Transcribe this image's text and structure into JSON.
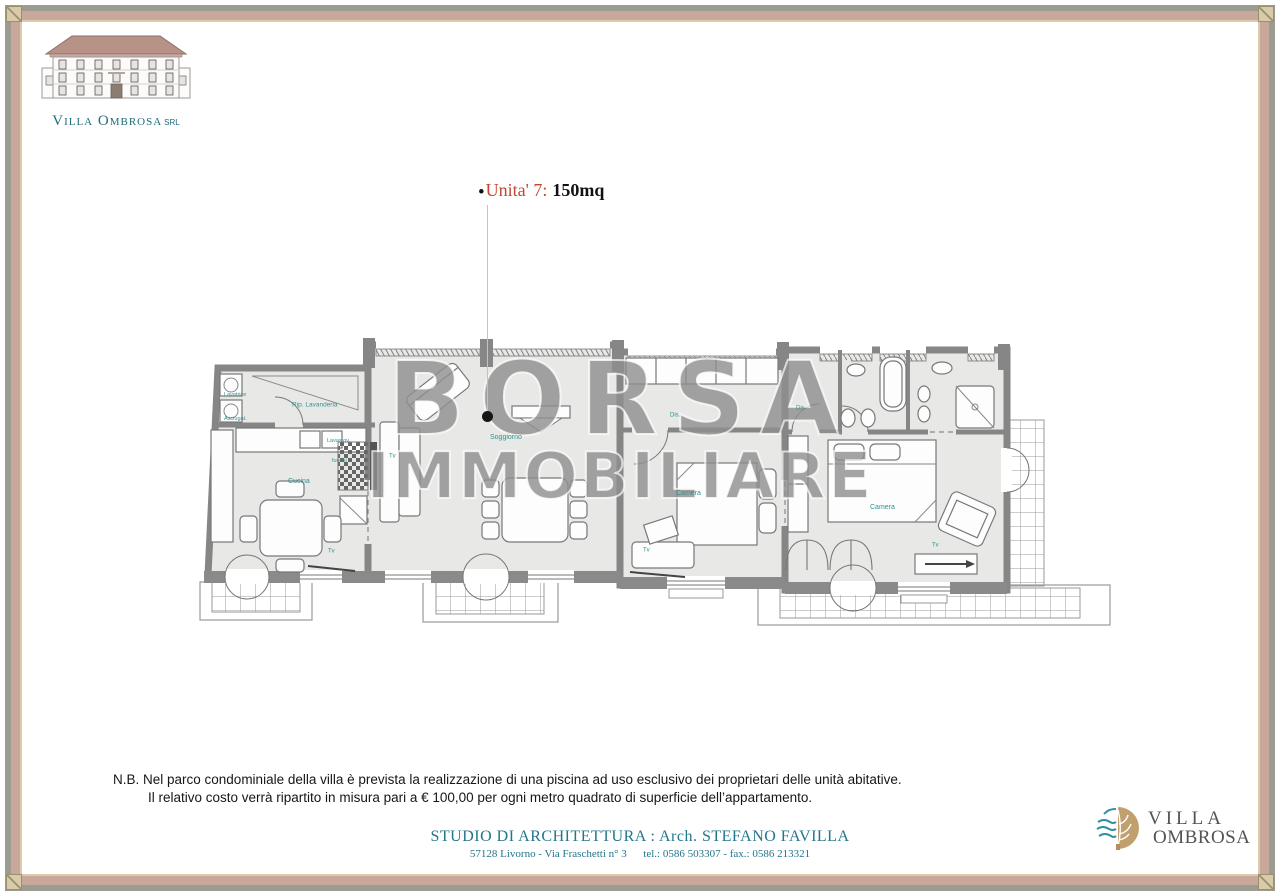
{
  "header_logo": {
    "name": "Villa Ombrosa",
    "suffix": "SRL"
  },
  "title": {
    "bullet": "•",
    "unit": "Unita' 7:",
    "area": "150mq"
  },
  "watermark": {
    "line1": "BORSA",
    "line2": "IMMOBILIARE"
  },
  "plan": {
    "labels": [
      {
        "id": "lavatrice",
        "text": "Lavatrice",
        "x": 44,
        "y": 62,
        "fs": 5.5
      },
      {
        "id": "asciugat",
        "text": "Asciugat.",
        "x": 44,
        "y": 86,
        "fs": 5.5
      },
      {
        "id": "rip-lavanderia",
        "text": "Rip. Lavanderia",
        "x": 112,
        "y": 72,
        "fs": 6.5
      },
      {
        "id": "lavastov",
        "text": "Lavastov.",
        "x": 147,
        "y": 108,
        "fs": 5.5
      },
      {
        "id": "fuochi",
        "text": "fuochi",
        "x": 152,
        "y": 128,
        "fs": 5.5
      },
      {
        "id": "cucina",
        "text": "Cucina",
        "x": 108,
        "y": 148,
        "fs": 7
      },
      {
        "id": "tv-cucina",
        "text": "Tv",
        "x": 148,
        "y": 218,
        "fs": 6
      },
      {
        "id": "tv-soggiorno",
        "text": "Tv",
        "x": 209,
        "y": 123,
        "fs": 6
      },
      {
        "id": "soggiorno",
        "text": "Soggiorno",
        "x": 310,
        "y": 104,
        "fs": 7
      },
      {
        "id": "dis-1",
        "text": "Dis.",
        "x": 490,
        "y": 82,
        "fs": 6
      },
      {
        "id": "camera-1",
        "text": "Camera",
        "x": 496,
        "y": 160,
        "fs": 7
      },
      {
        "id": "tv-camera1",
        "text": "Tv",
        "x": 463,
        "y": 217,
        "fs": 6
      },
      {
        "id": "dis-2",
        "text": "Dis.",
        "x": 616,
        "y": 75,
        "fs": 6
      },
      {
        "id": "camera-2",
        "text": "Camera",
        "x": 690,
        "y": 174,
        "fs": 7
      },
      {
        "id": "tv-camera2",
        "text": "Tv",
        "x": 752,
        "y": 212,
        "fs": 6
      }
    ]
  },
  "note": {
    "line1": "N.B. Nel parco condominiale della villa è prevista la realizzazione di una piscina ad uso esclusivo dei proprietari delle unità abitative.",
    "line2": "Il relativo costo verrà ripartito in misura pari a € 100,00 per ogni metro quadrato di superficie dell’appartamento."
  },
  "studio": {
    "title": "STUDIO DI ARCHITETTURA : Arch. STEFANO FAVILLA",
    "address": "57128 Livorno - Via Fraschetti n° 3      tel.: 0586 503307 - fax.: 0586 213321"
  },
  "footer_logo": {
    "line1": "VILLA",
    "line2": "OMBROSA"
  },
  "colors": {
    "label_teal": "#2c9393",
    "title_red": "#c3452f",
    "studio_teal": "#23768a",
    "wall_gray": "#868686",
    "watermark_gray": "#8f8f8f",
    "frame_gray": "#9b9b8f",
    "frame_rose": "#c9a79c",
    "frame_cream": "#d9ccab"
  }
}
